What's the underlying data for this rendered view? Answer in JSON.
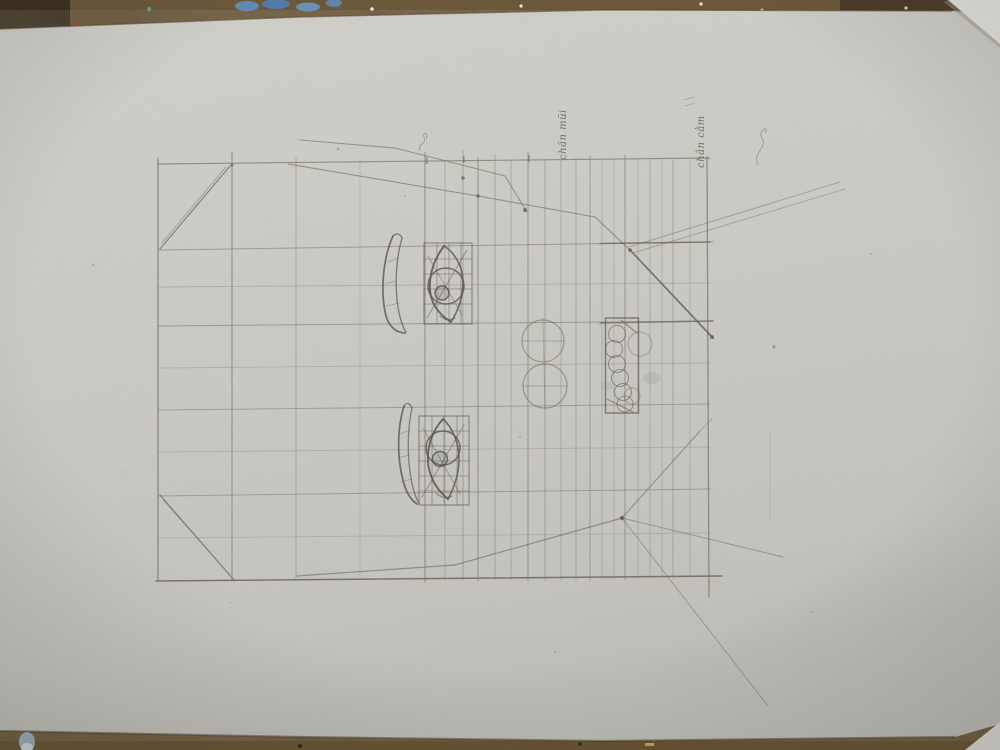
{
  "scene": {
    "kind": "photograph of a pencil drawing study on paper",
    "subject": "face proportion grid with eye, eyebrow, nose and lip constructions"
  },
  "annotations": {
    "label_nose_base": "chân mũi",
    "label_chin_base": "chân cằm"
  },
  "palette": {
    "paper": "#cccbc5",
    "paper_bright": "#d4d3cd",
    "paper_dim": "#c0bfb9",
    "table_wood": "#6b5636",
    "table_dark": "#423522",
    "pencil_light": "#8b897f",
    "pencil_dark": "#55524b",
    "paint_blue": "#5d8fc4",
    "paint_red": "#b03b33",
    "wedge_paper": "#e3e2dc"
  }
}
